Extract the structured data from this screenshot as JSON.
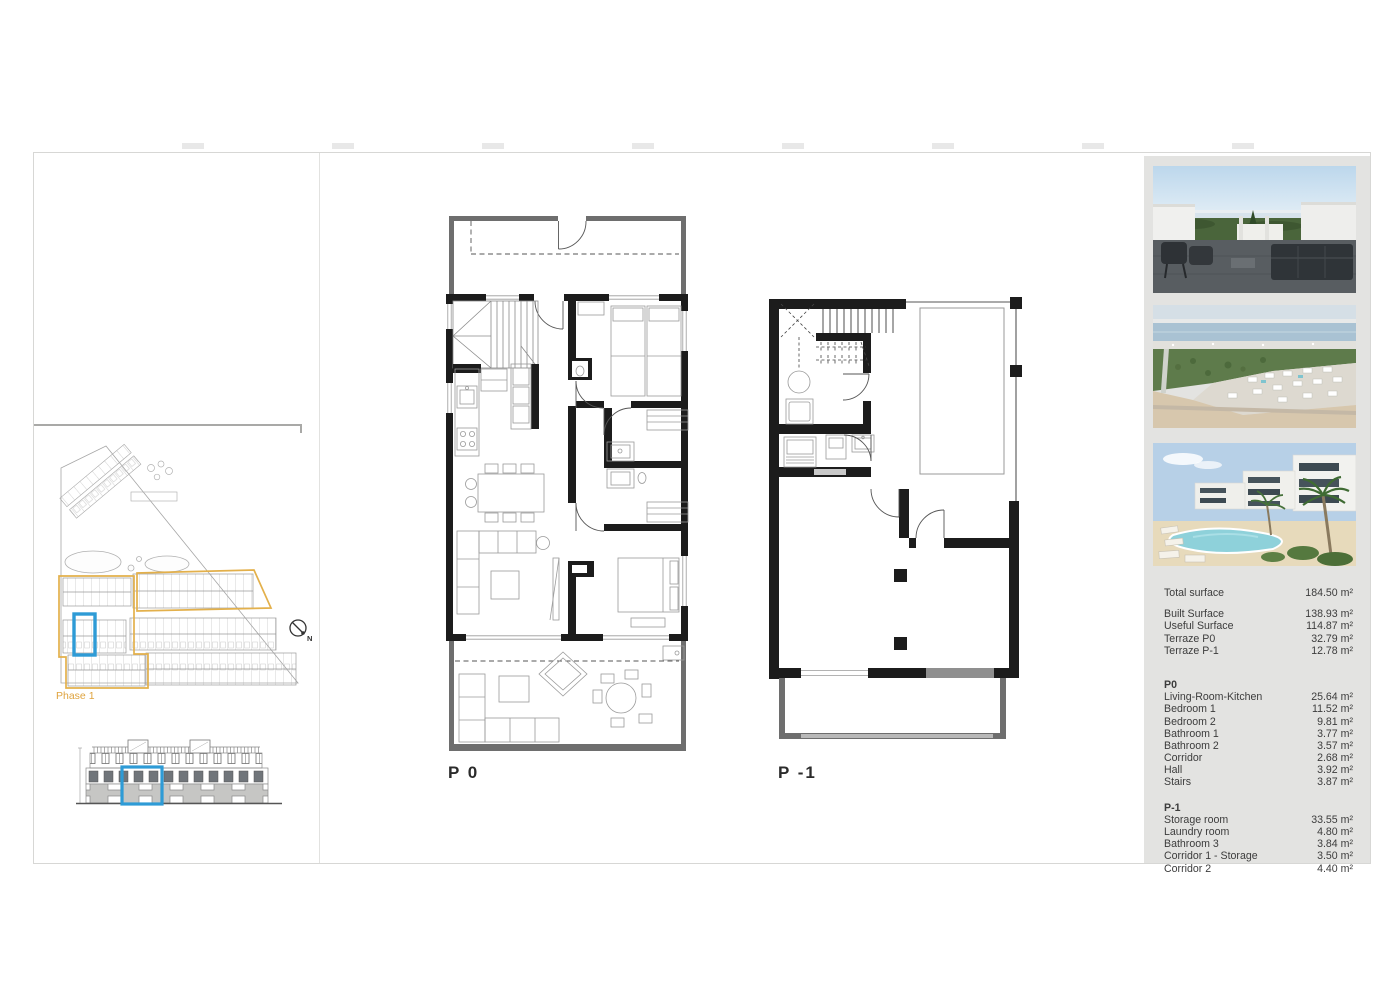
{
  "document": {
    "plan_labels": {
      "p0": "P 0",
      "p_minus_1": "P -1"
    },
    "site": {
      "phase_label": "Phase 1",
      "compass_north": "N"
    },
    "colors": {
      "highlight_blue": "#2e9bd6",
      "phase_yellow": "#e3b04b",
      "sidebar_bg": "#e3e3e1"
    }
  },
  "sidebar": {
    "summary_total": {
      "label": "Total surface",
      "value": "184.50 m²"
    },
    "summary_rows": [
      {
        "label": "Built Surface",
        "value": "138.93 m²"
      },
      {
        "label": "Useful Surface",
        "value": "114.87 m²"
      },
      {
        "label": "Terraze P0",
        "value": "32.79 m²"
      },
      {
        "label": "Terraze P-1",
        "value": "12.78 m²"
      }
    ],
    "p0": {
      "heading": "P0",
      "rows": [
        {
          "label": "Living-Room-Kitchen",
          "value": "25.64 m²"
        },
        {
          "label": "Bedroom 1",
          "value": "11.52 m²"
        },
        {
          "label": "Bedroom 2",
          "value": "9.81 m²"
        },
        {
          "label": "Bathroom 1",
          "value": "3.77 m²"
        },
        {
          "label": "Bathroom 2",
          "value": "3.57 m²"
        },
        {
          "label": "Corridor",
          "value": "2.68 m²"
        },
        {
          "label": "Hall",
          "value": "3.92 m²"
        },
        {
          "label": "Stairs",
          "value": "3.87 m²"
        }
      ]
    },
    "p1": {
      "heading": "P-1",
      "rows": [
        {
          "label": "Storage room",
          "value": "33.55 m²"
        },
        {
          "label": "Laundry room",
          "value": "4.80 m²"
        },
        {
          "label": "Bathroom 3",
          "value": "3.84 m²"
        },
        {
          "label": "Corridor 1 - Storage",
          "value": "3.50 m²"
        },
        {
          "label": "Corridor 2",
          "value": "4.40 m²"
        }
      ]
    }
  }
}
